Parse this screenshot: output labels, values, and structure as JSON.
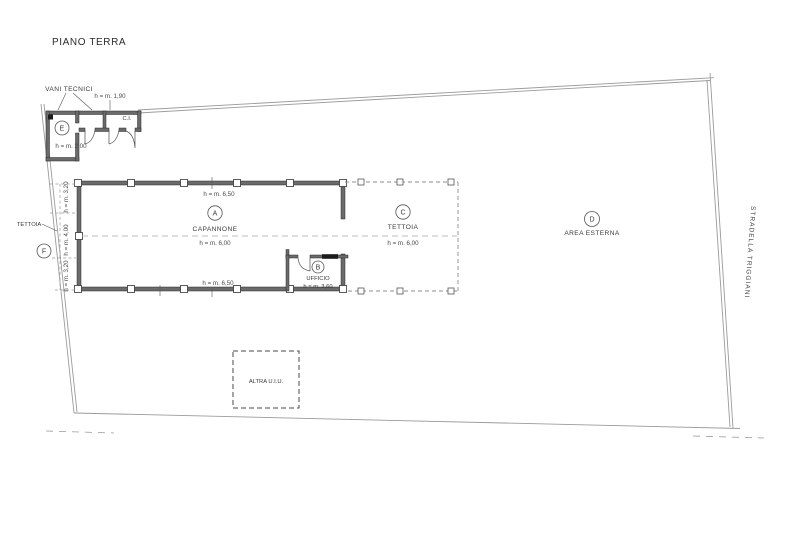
{
  "title": "PIANO TERRA",
  "street": "STRADELLA TRIGGIANI",
  "rooms": {
    "capannone": {
      "code": "A",
      "name": "CAPANNONE",
      "h_mid": "h = m. 6,00",
      "h_top": "h = m. 6,50",
      "h_bottom": "h = m. 6,50"
    },
    "ufficio": {
      "code": "B",
      "name": "UFFICIO",
      "h": "h = m. 3,60"
    },
    "tettoia_c": {
      "code": "C",
      "name": "TETTOIA",
      "h": "h = m. 6,00"
    },
    "area_esterna": {
      "code": "D",
      "name": "AREA ESTERNA"
    },
    "vani_tecnici": {
      "code": "E",
      "label": "VANI TECNICI",
      "h": "h = m. 2,00",
      "h_small": "h = m. 1,90",
      "ci": "C.I."
    },
    "tettoia_f": {
      "code": "F",
      "name": "TETTOIA",
      "h_sections": [
        "h = m. 3,20",
        "h = m. 4,00",
        "h = m. 3,20"
      ]
    }
  },
  "other_unit": {
    "label": "ALTRA U.I.U."
  },
  "colors": {
    "background": "#ffffff",
    "wall": "#6b6b6b",
    "line": "#3a3a3a",
    "boundary": "#9b9b9b"
  }
}
